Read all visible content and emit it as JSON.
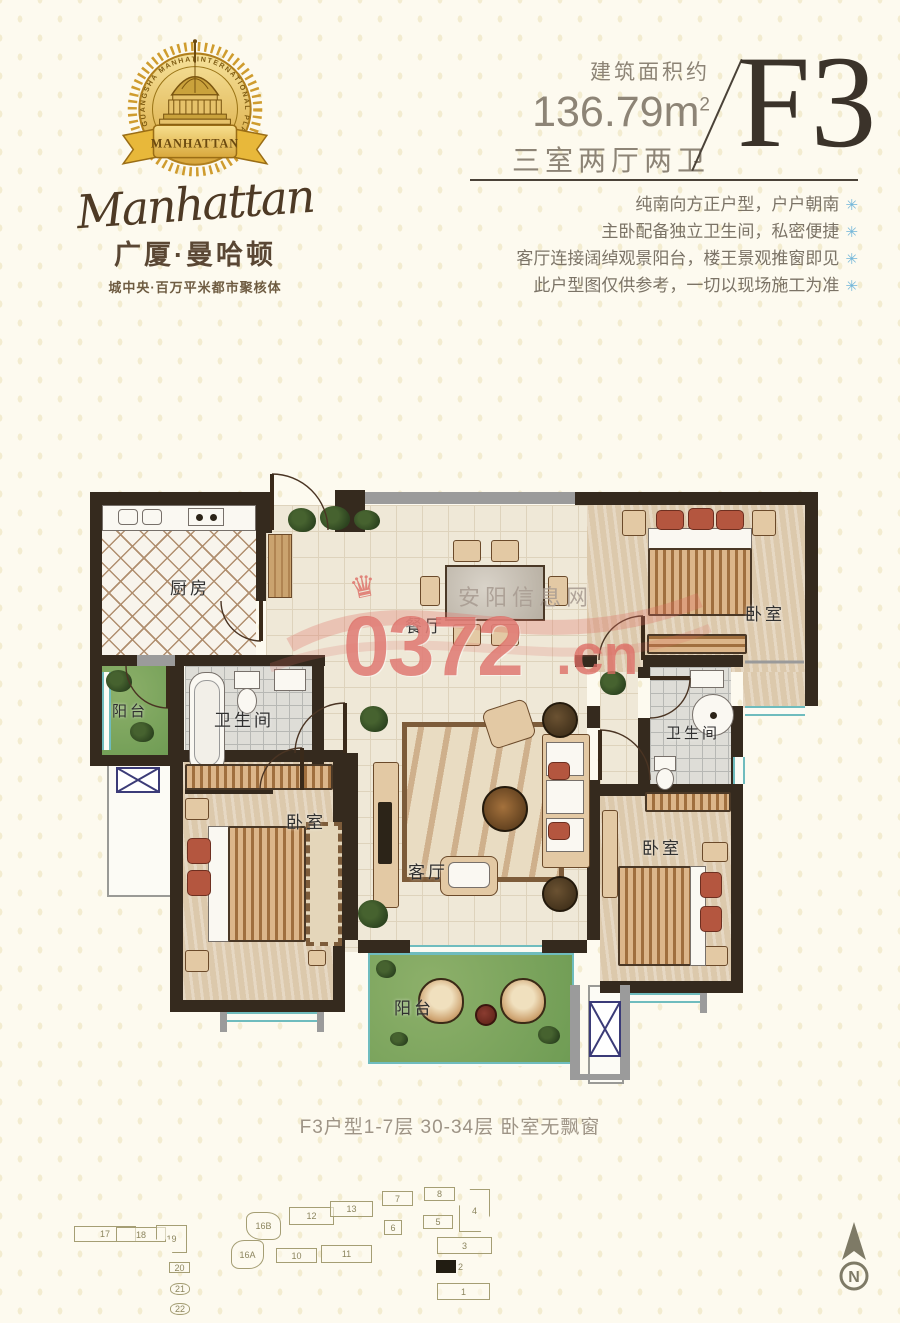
{
  "brand": {
    "arc_left": "GUANGSHA MANHATTAN",
    "arc_right": "INTERNATIONAL PLAZA",
    "ribbon": "MANHATTAN",
    "script": "Manhattan",
    "name_cn": "广厦·曼哈顿",
    "tagline": "城中央·百万平米都市聚核体"
  },
  "header": {
    "area_label": "建筑面积约",
    "area_value": "136.79m",
    "area_sup": "2",
    "layout_desc": "三室两厅两卫",
    "unit_code": "F3",
    "bullet_mark": "✳",
    "selling_points": [
      "纯南向方正户型，户户朝南",
      "主卧配备独立卫生间，私密便捷",
      "客厅连接阔绰观景阳台，楼王景观推窗即见",
      "此户型图仅供参考，一切以现场施工为准"
    ]
  },
  "floorplan": {
    "labels": [
      {
        "text": "厨房",
        "x": 80,
        "y": 108
      },
      {
        "text": "餐厅",
        "x": 315,
        "y": 146
      },
      {
        "text": "卧室",
        "x": 655,
        "y": 134
      },
      {
        "text": "阳台",
        "x": 22,
        "y": 234,
        "small": true
      },
      {
        "text": "卫生间",
        "x": 124,
        "y": 240
      },
      {
        "text": "卫生间",
        "x": 576,
        "y": 256,
        "small": true
      },
      {
        "text": "客厅",
        "x": 318,
        "y": 392
      },
      {
        "text": "卧室",
        "x": 196,
        "y": 342
      },
      {
        "text": "卧室",
        "x": 552,
        "y": 368
      },
      {
        "text": "阳台",
        "x": 304,
        "y": 528
      }
    ]
  },
  "watermark": {
    "number_prefix": "0",
    "number": "372",
    "tld": ".cn",
    "site_name": "安阳信息网",
    "crown": "♛"
  },
  "caption": "F3户型1-7层 30-34层 卧室无飘窗",
  "siteplan": {
    "compass": "N",
    "buildings": [
      {
        "label": "17",
        "x": 74,
        "y": 1226,
        "w": 62,
        "h": 16
      },
      {
        "label": "18",
        "x": 116,
        "y": 1227,
        "w": 50,
        "h": 15
      },
      {
        "label": "19",
        "x": 156,
        "y": 1225,
        "w": 31,
        "h": 28,
        "shape": "L"
      },
      {
        "label": "20",
        "x": 169,
        "y": 1262,
        "w": 21,
        "h": 11
      },
      {
        "label": "21",
        "x": 170,
        "y": 1283,
        "w": 20,
        "h": 12,
        "shape": "round"
      },
      {
        "label": "22",
        "x": 170,
        "y": 1303,
        "w": 20,
        "h": 12,
        "shape": "round"
      },
      {
        "label": "16B",
        "x": 246,
        "y": 1212,
        "w": 35,
        "h": 28,
        "shape": "blob1"
      },
      {
        "label": "16A",
        "x": 231,
        "y": 1240,
        "w": 33,
        "h": 29,
        "shape": "blob2"
      },
      {
        "label": "12",
        "x": 289,
        "y": 1207,
        "w": 45,
        "h": 18
      },
      {
        "label": "13",
        "x": 330,
        "y": 1201,
        "w": 43,
        "h": 16
      },
      {
        "label": "10",
        "x": 276,
        "y": 1248,
        "w": 41,
        "h": 15
      },
      {
        "label": "11",
        "x": 321,
        "y": 1245,
        "w": 51,
        "h": 18
      },
      {
        "label": "7",
        "x": 382,
        "y": 1191,
        "w": 31,
        "h": 15
      },
      {
        "label": "8",
        "x": 424,
        "y": 1187,
        "w": 31,
        "h": 14
      },
      {
        "label": "6",
        "x": 384,
        "y": 1220,
        "w": 18,
        "h": 15
      },
      {
        "label": "5",
        "x": 423,
        "y": 1215,
        "w": 30,
        "h": 14
      },
      {
        "label": "4",
        "x": 459,
        "y": 1189,
        "w": 31,
        "h": 43,
        "shape": "tower"
      },
      {
        "label": "3",
        "x": 437,
        "y": 1237,
        "w": 55,
        "h": 17
      },
      {
        "label": "2",
        "x": 436,
        "y": 1260,
        "w": 20,
        "h": 13,
        "shape": "filled"
      },
      {
        "label": "1",
        "x": 437,
        "y": 1283,
        "w": 53,
        "h": 17
      }
    ]
  },
  "colors": {
    "gold": "#d3a337",
    "brand_brown": "#5a4734",
    "heading_dark": "#3b332a",
    "text_gray": "#8d8476",
    "star_blue": "#72b6d9",
    "wall_dark": "#352a1e",
    "window_teal": "#6fbcbe",
    "balcony_green": "#6f9c54",
    "watermark_pink": "#dd6c64"
  }
}
